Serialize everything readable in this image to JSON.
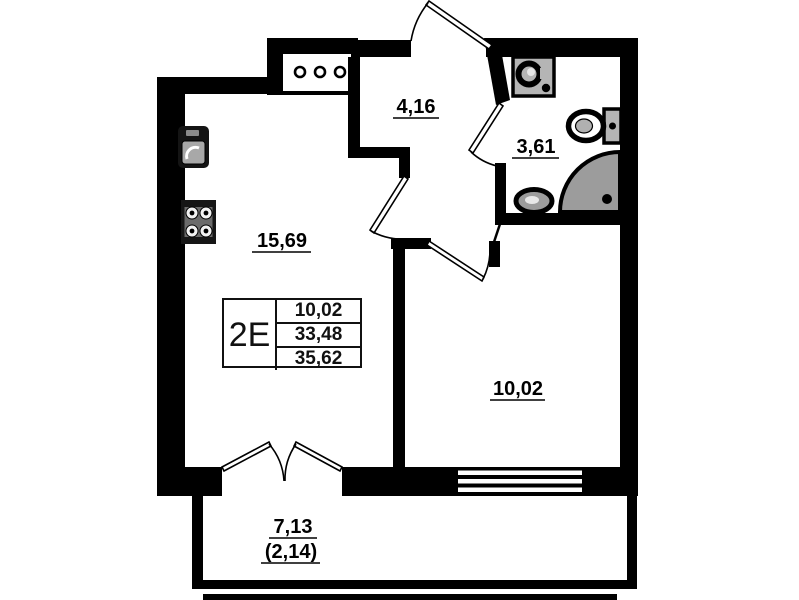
{
  "plan": {
    "info_table": {
      "unit_label": "2E",
      "rows": [
        "10,02",
        "33,48",
        "35,62"
      ]
    },
    "rooms": {
      "living_kitchen_area": "15,69",
      "hallway_area": "4,16",
      "bathroom_area": "3,61",
      "bedroom_area": "10,02",
      "balcony_area": "7,13",
      "balcony_reduced_area": "(2,14)"
    },
    "fixtures": [
      "ventilation-shaft",
      "kitchen-sink",
      "stove",
      "washing-machine",
      "toilet",
      "corner-shower",
      "bathroom-sink"
    ],
    "colors": {
      "wall": "#000000",
      "background": "#ffffff",
      "fixture_gray": "#9c9c9c"
    }
  }
}
